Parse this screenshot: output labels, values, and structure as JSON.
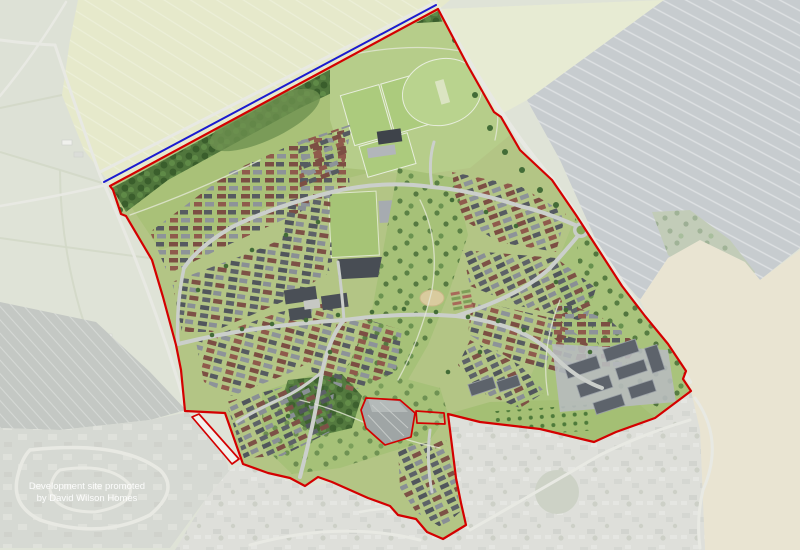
{
  "caption": {
    "line1": "Development site promoted",
    "line2": "by David Wilson Homes"
  },
  "colors": {
    "boundary_red": "#d40000",
    "boundary_blue": "#1b1bd0",
    "caption_text": "#ffffff",
    "masterplan_green": "#b3c585",
    "woodland_green": "#50763c",
    "roof_brown": "#7c4e43",
    "roof_grey": "#51565c",
    "aerial_field_grey": "#9fa7ad",
    "aerial_field_beige": "#dad1b2",
    "aerial_crop_green": "#d4daa6"
  }
}
